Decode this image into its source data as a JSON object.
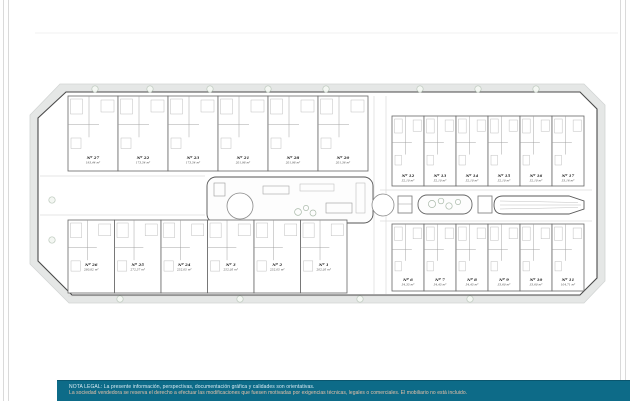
{
  "banner": {
    "line1": "NOTA LEGAL: La presente información, perspectivas, documentación gráfica y calidades son orientativas.",
    "line2": "La sociedad vendedora se reserva el derecho a efectuar las modificaciones que fuesen motivadas por exigencias técnicas, legales o comerciales. El mobiliario no está incluido.",
    "background_color": "#0d6b88"
  },
  "plan": {
    "description": "Residential development site plan with villas and townhouses around communal pool courtyards",
    "rows": [
      {
        "id": "villas-top",
        "units": [
          {
            "num": "Nº 27",
            "area": "193,44 m²"
          },
          {
            "num": "Nº 22",
            "area": "173,54 m²"
          },
          {
            "num": "Nº 23",
            "area": "173,54 m²"
          },
          {
            "num": "Nº 21",
            "area": "201,98 m²"
          },
          {
            "num": "Nº 28",
            "area": "201,98 m²"
          },
          {
            "num": "Nº 20",
            "area": "201,36 m²"
          }
        ]
      },
      {
        "id": "villas-bottom",
        "units": [
          {
            "num": "Nº 26",
            "area": "280,82 m²"
          },
          {
            "num": "Nº 25",
            "area": "272,57 m²"
          },
          {
            "num": "Nº 24",
            "area": "252,05 m²"
          },
          {
            "num": "Nº 3",
            "area": "252,05 m²"
          },
          {
            "num": "Nº 2",
            "area": "252,05 m²"
          },
          {
            "num": "Nº 1",
            "area": "202,05 m²"
          }
        ]
      },
      {
        "id": "townhouses-top",
        "units": [
          {
            "num": "Nº 12",
            "area": "52,10 m²"
          },
          {
            "num": "Nº 13",
            "area": "52,10 m²"
          },
          {
            "num": "Nº 14",
            "area": "52,10 m²"
          },
          {
            "num": "Nº 15",
            "area": "52,10 m²"
          },
          {
            "num": "Nº 16",
            "area": "52,10 m²"
          },
          {
            "num": "Nº 17",
            "area": "53,16 m²"
          }
        ]
      },
      {
        "id": "townhouses-bottom",
        "units": [
          {
            "num": "Nº 6",
            "area": "54,35 m²"
          },
          {
            "num": "Nº 7",
            "area": "54,45 m²"
          },
          {
            "num": "Nº 8",
            "area": "54,45 m²"
          },
          {
            "num": "Nº 9",
            "area": "33,60 m²"
          },
          {
            "num": "Nº 10",
            "area": "33,60 m²"
          },
          {
            "num": "Nº 11",
            "area": "104,71 m²"
          }
        ]
      }
    ]
  }
}
